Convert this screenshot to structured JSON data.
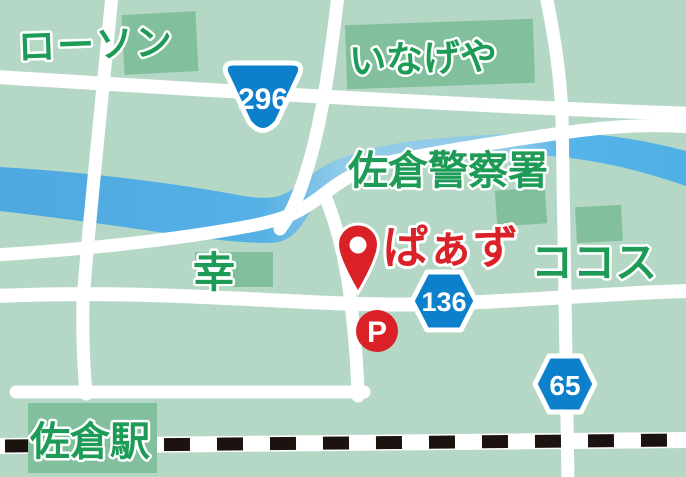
{
  "map": {
    "title": "access-map",
    "colors": {
      "background": "#b5d7c6",
      "building": "#82c09d",
      "road": "#ffffff",
      "river_saturated": "#53afe4",
      "river_pale": "#93cce9",
      "railway_black": "#1c1310",
      "label_green": "#1e9b57",
      "accent_red": "#da2127",
      "badge_blue": "#0d80cc"
    },
    "labels": {
      "lawson": "ローソン",
      "inageya": "いなげや",
      "police_station": "佐倉警察署",
      "destination": "ぱぁず",
      "cocos": "ココス",
      "sachi": "幸",
      "station": "佐倉駅"
    },
    "route_badges": {
      "route_296": "296",
      "route_136": "136",
      "route_65": "65"
    },
    "markers": {
      "parking": "P",
      "pin": "destination-pin"
    }
  }
}
